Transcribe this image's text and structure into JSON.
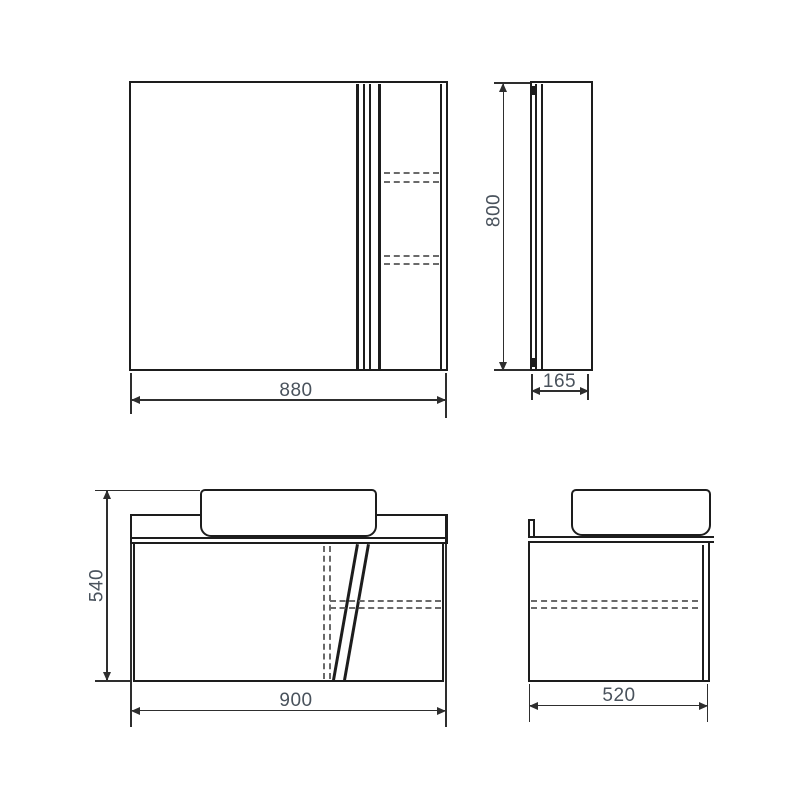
{
  "drawing_title": "bathroom-furniture-technical-drawing",
  "views": {
    "mirror_front": {
      "width": "880"
    },
    "mirror_side": {
      "height": "800",
      "depth": "165"
    },
    "vanity_front": {
      "height": "540",
      "width": "900"
    },
    "vanity_side": {
      "depth": "520"
    }
  },
  "colors": {
    "line": "#1d1d1d",
    "dashed_line": "#6a6a6a",
    "dimension_line": "#2e2e2e",
    "label_text": "#49525c",
    "background": "#ffffff"
  }
}
